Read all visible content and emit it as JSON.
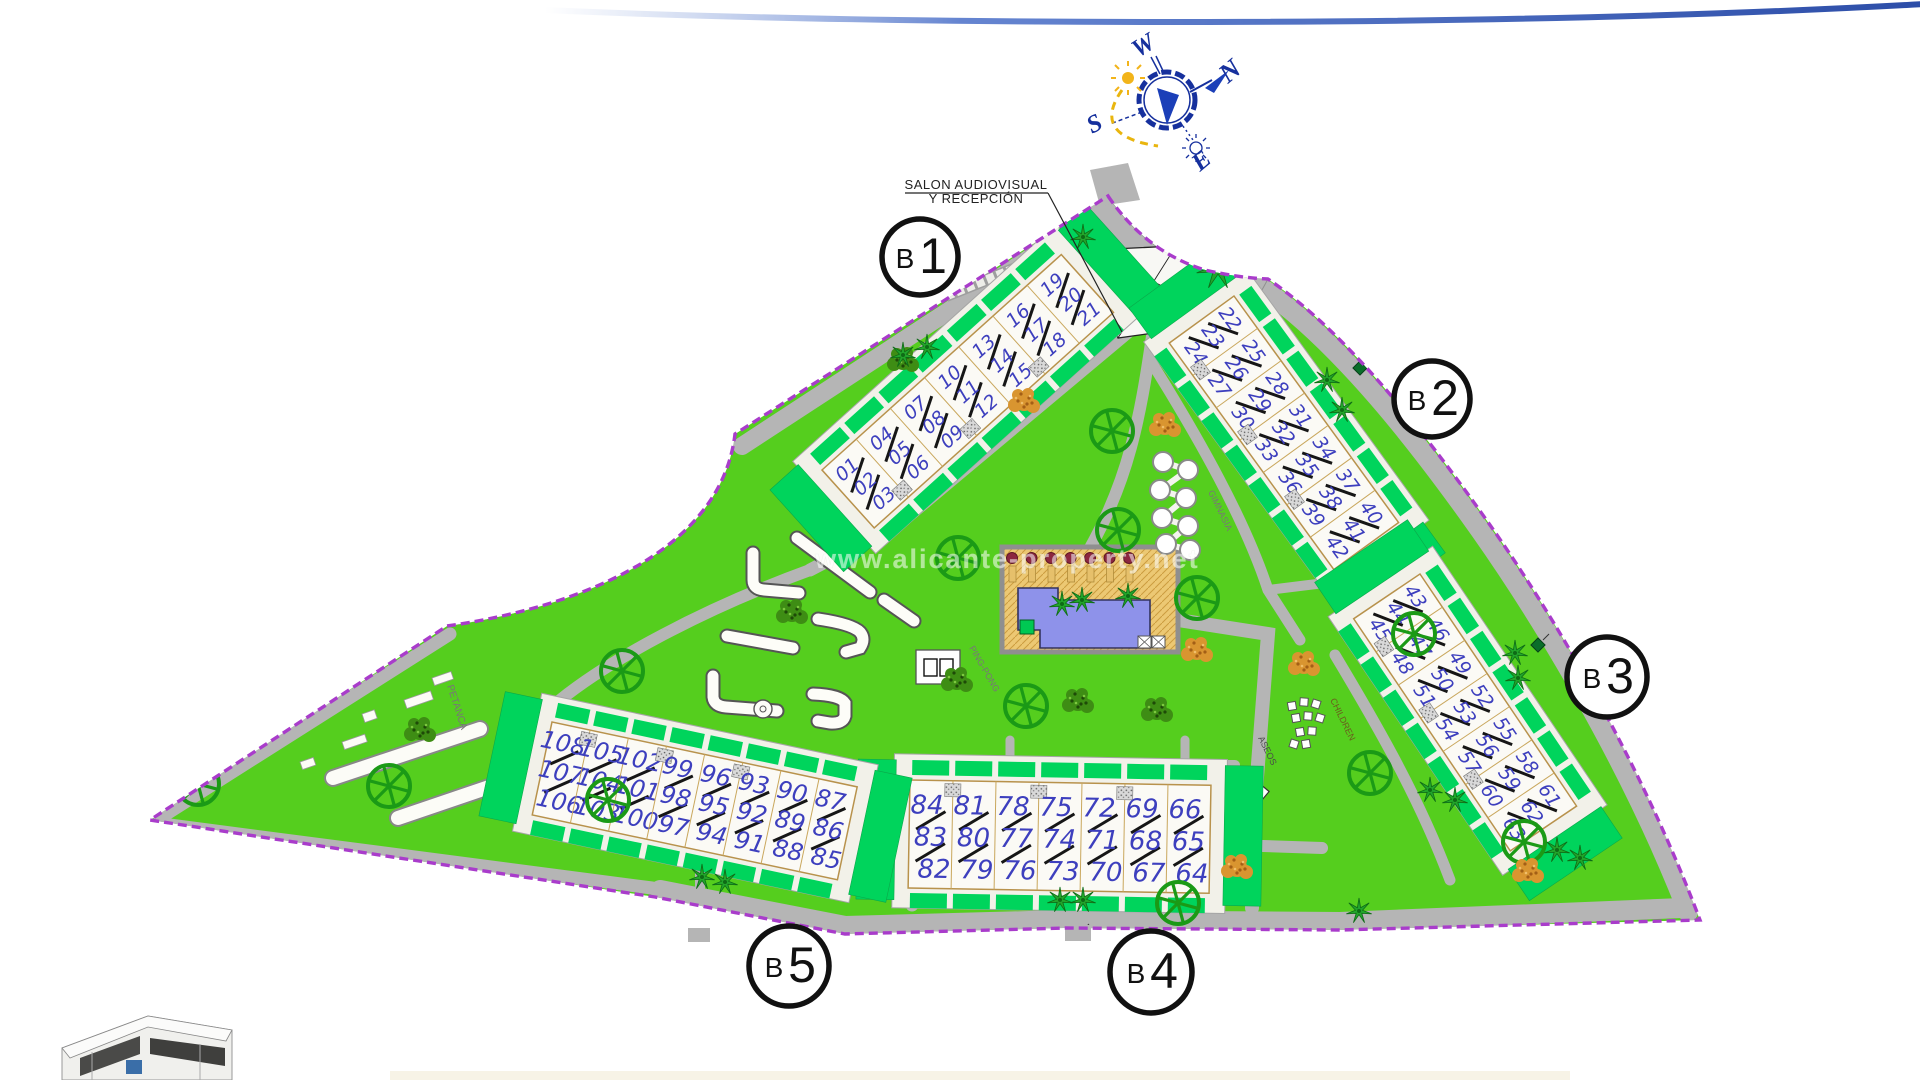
{
  "site": {
    "watermark": "www.alicante-property.net",
    "boundary_color": "#A93CCB",
    "lawn_color": "#55CE1E",
    "garden_color": "#00D45C",
    "road_color": "#B5B5B5",
    "unit_number_color": "#3D3FBE",
    "pool_color": "#8E92EA",
    "deck_color": "#ECC873",
    "parasol_color": "#8C2740",
    "tree_color": "#1B9A16"
  },
  "labels": {
    "reception_line1": "SALON AUDIOVISUAL",
    "reception_line2": "Y RECEPCIÓN",
    "petanca": "PETANCA",
    "ping_pong": "PING-PONG",
    "gym": "GIMNASIA",
    "children": "CHILDREN",
    "toilets": "ASEOS"
  },
  "compass": {
    "north": "N",
    "south": "S",
    "east": "E",
    "west": "W"
  },
  "blocks": [
    {
      "id": "B1",
      "letter": "B",
      "number": "1",
      "units": [
        [
          "01",
          "02",
          "03"
        ],
        [
          "04",
          "05",
          "06"
        ],
        [
          "07",
          "08",
          "09"
        ],
        [
          "10",
          "11",
          "12"
        ],
        [
          "13",
          "14",
          "15"
        ],
        [
          "16",
          "17",
          "18"
        ],
        [
          "19",
          "20",
          "21"
        ]
      ]
    },
    {
      "id": "B2",
      "letter": "B",
      "number": "2",
      "units": [
        [
          "22",
          "23",
          "24"
        ],
        [
          "25",
          "26",
          "27"
        ],
        [
          "28",
          "29",
          "30"
        ],
        [
          "31",
          "32",
          "33"
        ],
        [
          "34",
          "35",
          "36"
        ],
        [
          "37",
          "38",
          "39"
        ],
        [
          "40",
          "41",
          "42"
        ]
      ]
    },
    {
      "id": "B3",
      "letter": "B",
      "number": "3",
      "units": [
        [
          "43",
          "44",
          "45"
        ],
        [
          "46",
          "47",
          "48"
        ],
        [
          "49",
          "50",
          "51"
        ],
        [
          "52",
          "53",
          "54"
        ],
        [
          "55",
          "56",
          "57"
        ],
        [
          "58",
          "59",
          "60"
        ],
        [
          "61",
          "62",
          "63"
        ]
      ]
    },
    {
      "id": "B4",
      "letter": "B",
      "number": "4",
      "units": [
        [
          "84",
          "83",
          "82"
        ],
        [
          "81",
          "80",
          "79"
        ],
        [
          "78",
          "77",
          "76"
        ],
        [
          "75",
          "74",
          "73"
        ],
        [
          "72",
          "71",
          "70"
        ],
        [
          "69",
          "68",
          "67"
        ],
        [
          "66",
          "65",
          "64"
        ]
      ]
    },
    {
      "id": "B5",
      "letter": "B",
      "number": "5",
      "units": [
        [
          "108",
          "107",
          "106"
        ],
        [
          "105",
          "104",
          "103"
        ],
        [
          "102",
          "101",
          "100"
        ],
        [
          "99",
          "98",
          "97"
        ],
        [
          "96",
          "95",
          "94"
        ],
        [
          "93",
          "92",
          "91"
        ],
        [
          "90",
          "89",
          "88"
        ],
        [
          "87",
          "86",
          "85"
        ]
      ]
    }
  ]
}
